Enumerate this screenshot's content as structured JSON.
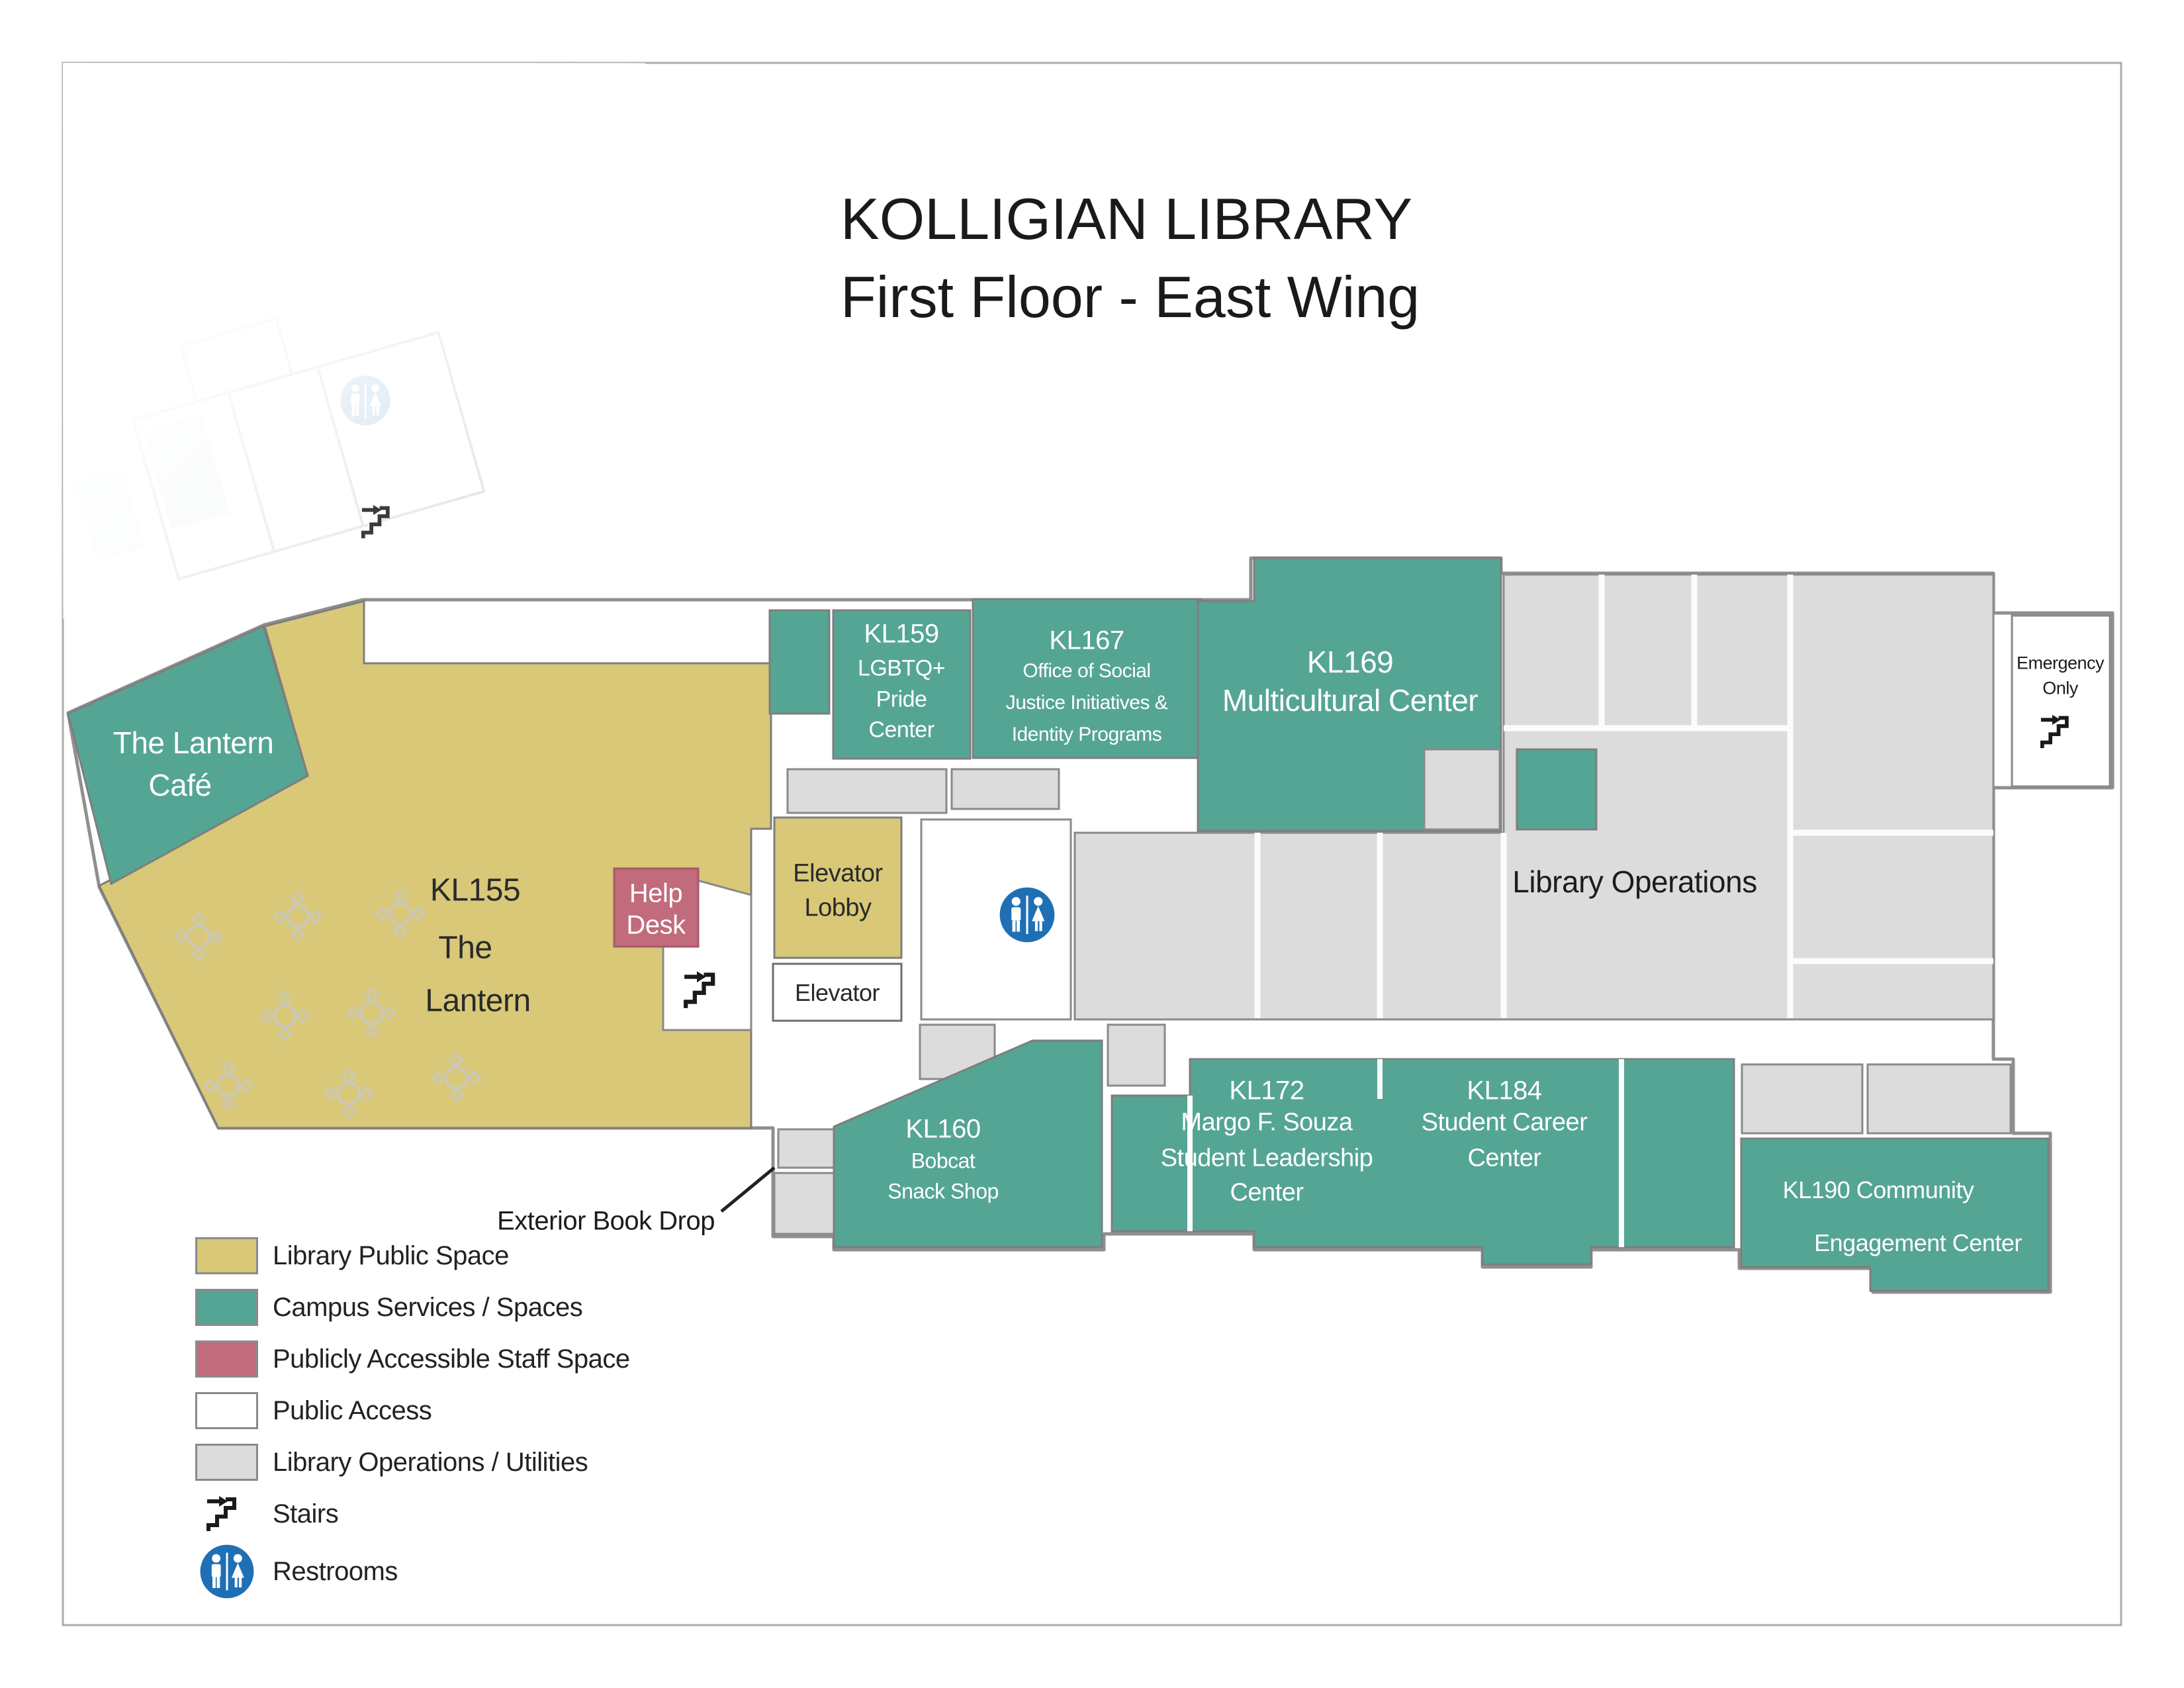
{
  "title": {
    "line1": "KOLLIGIAN LIBRARY",
    "line2": "First Floor - East Wing"
  },
  "rooms": {
    "cafe": {
      "lines": [
        "The Lantern",
        "Café"
      ]
    },
    "kl155": {
      "lines": [
        "KL155",
        "The",
        "Lantern"
      ]
    },
    "help_desk": {
      "lines": [
        "Help",
        "Desk"
      ]
    },
    "elevator_lobby": {
      "lines": [
        "Elevator",
        "Lobby"
      ]
    },
    "elevator": {
      "label": "Elevator"
    },
    "kl159": {
      "lines": [
        "KL159",
        "LGBTQ+",
        "Pride",
        "Center"
      ]
    },
    "kl167": {
      "lines": [
        "KL167",
        "Office of Social",
        "Justice Initiatives &",
        "Identity Programs"
      ]
    },
    "kl169": {
      "lines": [
        "KL169",
        "Multicultural Center"
      ]
    },
    "library_operations": {
      "label": "Library Operations"
    },
    "emergency": {
      "lines": [
        "Emergency",
        "Only"
      ]
    },
    "kl160": {
      "lines": [
        "KL160",
        "Bobcat",
        "Snack Shop"
      ]
    },
    "kl172": {
      "lines": [
        "KL172",
        "Margo F. Souza",
        "Student Leadership",
        "Center"
      ]
    },
    "kl184": {
      "lines": [
        "KL184",
        "Student Career",
        "Center"
      ]
    },
    "kl190": {
      "lines": [
        "KL190 Community",
        "Engagement Center"
      ]
    }
  },
  "annotations": {
    "book_drop": "Exterior Book Drop"
  },
  "legend": {
    "items": [
      {
        "label": "Library Public Space",
        "color": "#D8C878"
      },
      {
        "label": "Campus Services / Spaces",
        "color": "#55A594"
      },
      {
        "label": "Publicly Accessible Staff Space",
        "color": "#C16B7C"
      },
      {
        "label": "Public Access",
        "color": "#FFFFFF"
      },
      {
        "label": "Library Operations / Utilities",
        "color": "#DCDCDC"
      }
    ],
    "stairs_label": "Stairs",
    "restrooms_label": "Restrooms"
  },
  "colors": {
    "library_public_space": "#D8C878",
    "campus_services": "#55A594",
    "staff_space": "#C16B7C",
    "public_access": "#FFFFFF",
    "operations_utilities": "#DCDCDC",
    "wall": "#8F8F8F",
    "restroom_blue": "#1F6FB5",
    "text": "#1C1C1C"
  }
}
